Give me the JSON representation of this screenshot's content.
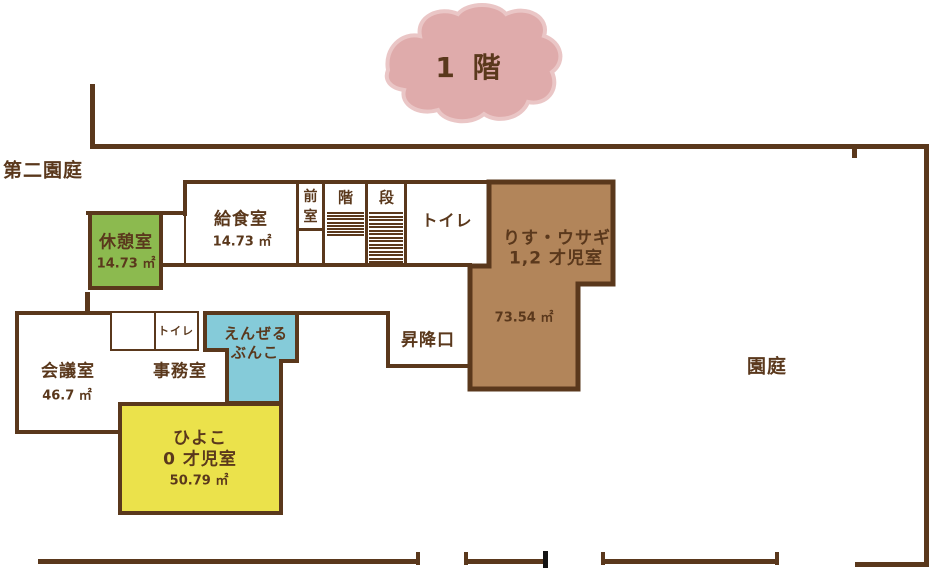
{
  "title": {
    "floor_label": "1 階"
  },
  "site": {
    "second_garden_label": "第二園庭",
    "garden_label": "園庭",
    "entrance_label": "昇降口"
  },
  "rooms": {
    "break_room": {
      "name": "休憩室",
      "area": "14.73 ㎡"
    },
    "kitchen": {
      "name": "給食室",
      "area": "14.73 ㎡"
    },
    "anteroom": {
      "chars": [
        "前",
        "室"
      ]
    },
    "stairs": {
      "char1": "階",
      "char2": "段",
      "treads_left": 8,
      "treads_right": 15
    },
    "toilet_upper": {
      "name": "トイレ"
    },
    "risu_usagi": {
      "name": "りす・ウサギ",
      "name2": "1,2 才児室",
      "area": "73.54 ㎡"
    },
    "meeting": {
      "name": "会議室",
      "area": "46.7 ㎡"
    },
    "office": {
      "name": "事務室"
    },
    "toilet_lower": {
      "name": "トイレ"
    },
    "angel_bunko": {
      "line1": "えんぜる",
      "line2": "ぶんこ"
    },
    "hiyoko": {
      "name": "ひよこ",
      "name2": "0 才児室",
      "area": "50.79 ㎡"
    }
  },
  "colors": {
    "wall": "#5a381c",
    "text": "#5a381c",
    "green": "#8cba4f",
    "brown_room": "#b2855a",
    "blue": "#85cbd9",
    "yellow": "#ebe24b",
    "cloud_fill": "#dfabab",
    "cloud_edge": "#eac6c6",
    "black_tick": "#141414"
  }
}
